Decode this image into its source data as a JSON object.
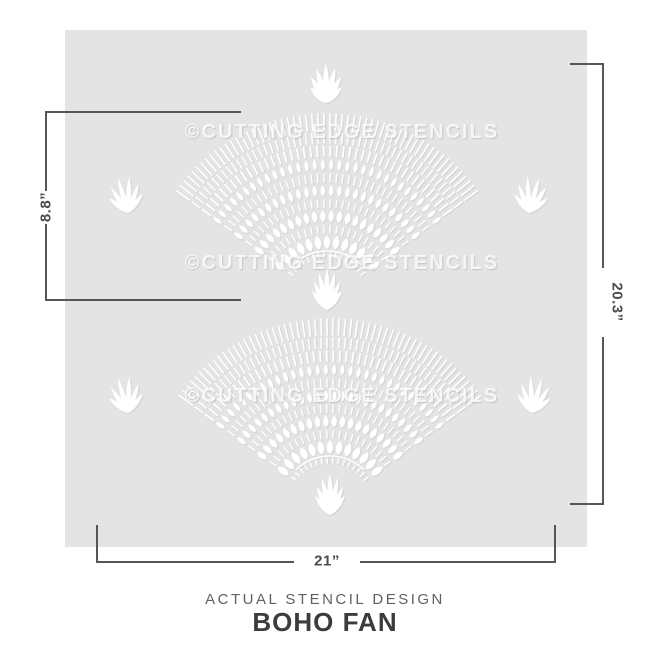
{
  "stencil": {
    "watermark_text": "©CUTTING EDGE STENCILS",
    "sheet_color": "#e4e4e4",
    "pattern_color": "#ffffff"
  },
  "dimensions": {
    "inner_height": "8.8”",
    "total_height": "20.3”",
    "total_width": "21”"
  },
  "caption": {
    "subtitle": "ACTUAL STENCIL DESIGN",
    "title": "BOHO FAN"
  },
  "colors": {
    "dimension_line": "#55565a",
    "dimension_text": "#4a4b4f",
    "subtitle_text": "#5f6165",
    "title_text": "#3b3c40",
    "watermark": "rgba(255,255,255,0.8)",
    "sheet_color": "#e4e4e4"
  }
}
